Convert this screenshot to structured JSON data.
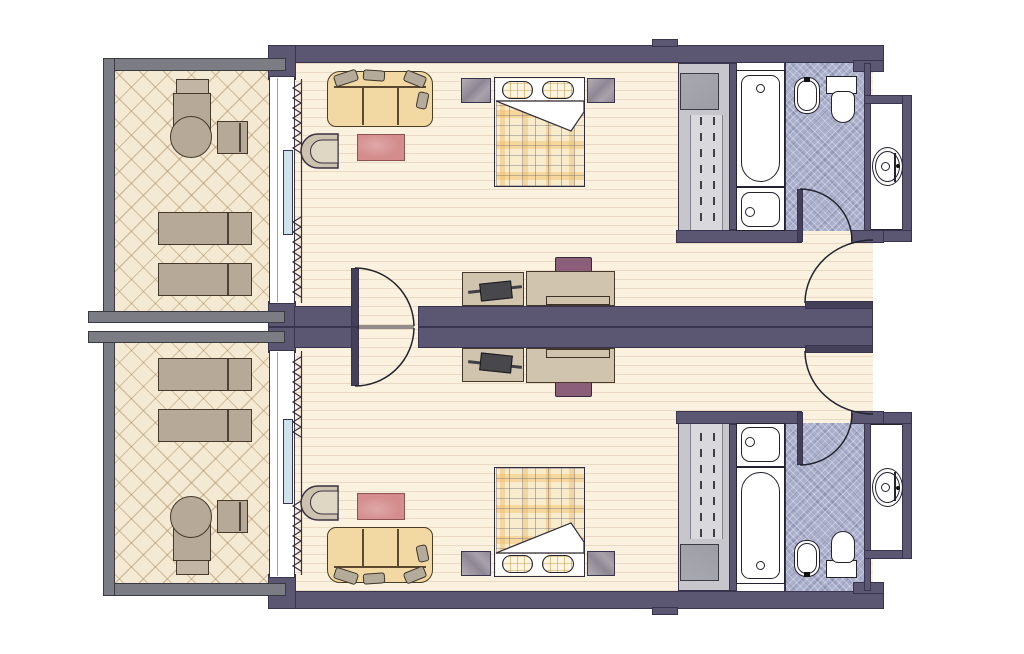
{
  "floor_plan": {
    "kind": "hotel-guest-rooms",
    "rooms": [
      {
        "id": "room-a",
        "position": "top"
      },
      {
        "id": "room-b",
        "position": "bottom",
        "mirror_of": "room-a"
      }
    ],
    "areas_per_room": [
      "balcony",
      "bedroom-living-area",
      "entry",
      "bathroom",
      "vanity-nook"
    ],
    "furniture_per_room": [
      "sofa",
      "armchair",
      "rug",
      "double-bed",
      "pillows",
      "nightstands",
      "console-table",
      "luggage-rack",
      "writing-desk",
      "desk-chair",
      "closet",
      "safe",
      "balcony-armchair",
      "balcony-round-table",
      "balcony-side-chair",
      "balcony-loungers"
    ],
    "fixtures_per_room": [
      "bathtub",
      "washbasin",
      "bidet",
      "toilet",
      "vanity-sink"
    ],
    "doors_per_room": [
      "entry-door",
      "bathroom-door",
      "connecting-door",
      "sliding-window",
      "curtains"
    ]
  },
  "colors": {
    "wall": "#5b5672",
    "wall-stroke": "#38344e",
    "rail": "#7c7c85",
    "rail-stroke": "#3a3a42",
    "floor": "#faf1de",
    "bfloor": "#f4ead4",
    "tile": "#a9aecb",
    "white": "#ffffff",
    "stroke": "#23222f",
    "closet": "#c6c6cc",
    "closet-inner": "#d9d9dd",
    "safe": "#9d9da5",
    "tan": "#b7a997",
    "tan-dark": "#44392a",
    "sofa": "#f2d8a2",
    "cushion": "#b5ab9b",
    "rug": "#d48c8c",
    "rug-stroke": "#8f5252",
    "plaid-base": "#f8eccd",
    "pillow": "#fdf5df",
    "desk": "#d0c4ae",
    "dark-item": "#47474c",
    "chair-purple": "#8b5f79",
    "pane": "#cfe3ef",
    "door-leaf": "#45405a"
  }
}
